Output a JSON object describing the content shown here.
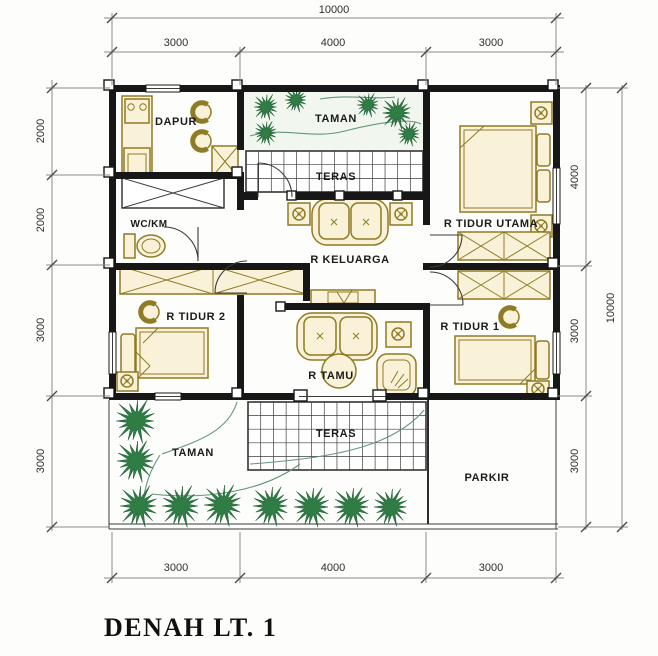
{
  "title": "DENAH LT. 1",
  "dims": {
    "top_total": "10000",
    "top_segments": [
      "3000",
      "4000",
      "3000"
    ],
    "bottom_segments": [
      "3000",
      "4000",
      "3000"
    ],
    "left_segments": [
      "2000",
      "2000",
      "3000",
      "3000"
    ],
    "right_segments": [
      "4000",
      "3000",
      "3000"
    ],
    "right_total": "10000"
  },
  "rooms": {
    "dapur": "DAPUR",
    "taman_top": "TAMAN",
    "teras_top": "TERAS",
    "wc_km": "WC/KM",
    "tidur_utama": "R TIDUR UTAMA",
    "keluarga": "R KELUARGA",
    "tidur_2": "R TIDUR 2",
    "tidur_1": "R TIDUR 1",
    "tamu": "R TAMU",
    "taman_front": "TAMAN",
    "teras_front": "TERAS",
    "parkir": "PARKIR"
  },
  "symbols": {
    "plant": "plant-burst-icon",
    "flower_pot": "flower-pot-icon",
    "bed": "bed-symbol",
    "sofa": "sofa-symbol",
    "wardrobe": "x-wardrobe-symbol",
    "toilet": "toilet-symbol",
    "stove": "stove-symbol",
    "tile_grid": "terrace-tile-grid"
  },
  "colors": {
    "walls": "#171717",
    "furniture_line": "#8f7b24",
    "furniture_fill": "#f9f2d8",
    "plants": "#2f7d45",
    "dimension_lines": "#8a8a8a",
    "text": "#1b1b1b"
  }
}
